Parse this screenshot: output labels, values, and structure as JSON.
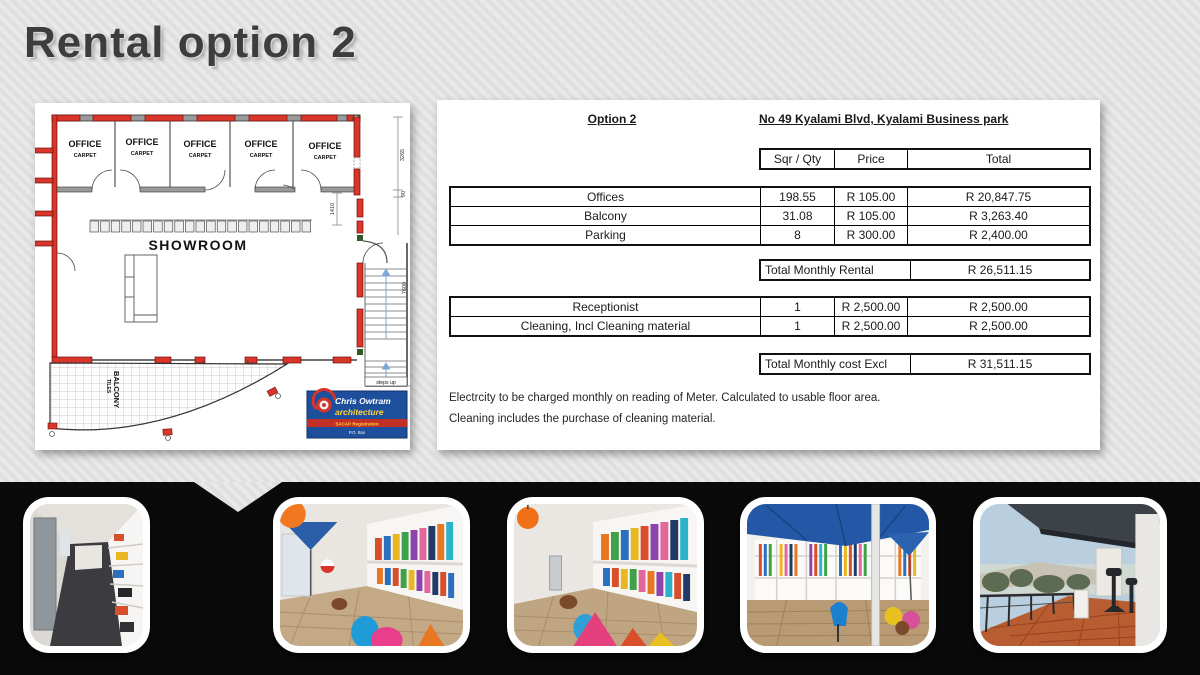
{
  "title": "Rental option 2",
  "floor_plan": {
    "office_label": "OFFICE",
    "office_sublabel": "CARPET",
    "showroom_label": "SHOWROOM",
    "balcony_label": "BALCONY",
    "balcony_sublabel": "TILES",
    "steps_label": "steps up",
    "dimensions": [
      "3265",
      "90",
      "7600",
      "1410"
    ],
    "logo": {
      "line1": "Chris Owtram",
      "line2": "architecture",
      "line3": "SACAP Registration",
      "line4": "P.O. Box"
    }
  },
  "pricing": {
    "option_label": "Option 2",
    "address": "No 49 Kyalami Blvd, Kyalami Business park",
    "col_qty": "Sqr / Qty",
    "col_price": "Price",
    "col_total": "Total",
    "rows": [
      {
        "label": "Offices",
        "qty": "198.55",
        "price": "R 105.00",
        "total": "R 20,847.75"
      },
      {
        "label": "Balcony",
        "qty": "31.08",
        "price": "R 105.00",
        "total": "R 3,263.40"
      },
      {
        "label": "Parking",
        "qty": "8",
        "price": "R 300.00",
        "total": "R 2,400.00"
      }
    ],
    "rental_total_label": "Total Monthly Rental",
    "rental_total_value": "R 26,511.15",
    "service_rows": [
      {
        "label": "Receptionist",
        "qty": "1",
        "price": "R 2,500.00",
        "total": "R 2,500.00"
      },
      {
        "label": "Cleaning, Incl Cleaning material",
        "qty": "1",
        "price": "R 2,500.00",
        "total": "R 2,500.00"
      }
    ],
    "cost_total_label": "Total Monthly cost Excl",
    "cost_total_value": "R 31,511.15",
    "notes": [
      "Electrcity to be charged monthly on reading of Meter. Calculated to usable floor area.",
      "Cleaning includes the purchase of cleaning material."
    ]
  },
  "photos": [
    {
      "name": "corridor"
    },
    {
      "name": "showroom-beanbags"
    },
    {
      "name": "showroom-shelving"
    },
    {
      "name": "showroom-umbrella"
    },
    {
      "name": "balcony-view"
    }
  ],
  "colors": {
    "background": "#e6e6e6",
    "band": "#0a0a0a",
    "wall_red": "#d8352b",
    "logo_blue": "#1d4f9c"
  }
}
